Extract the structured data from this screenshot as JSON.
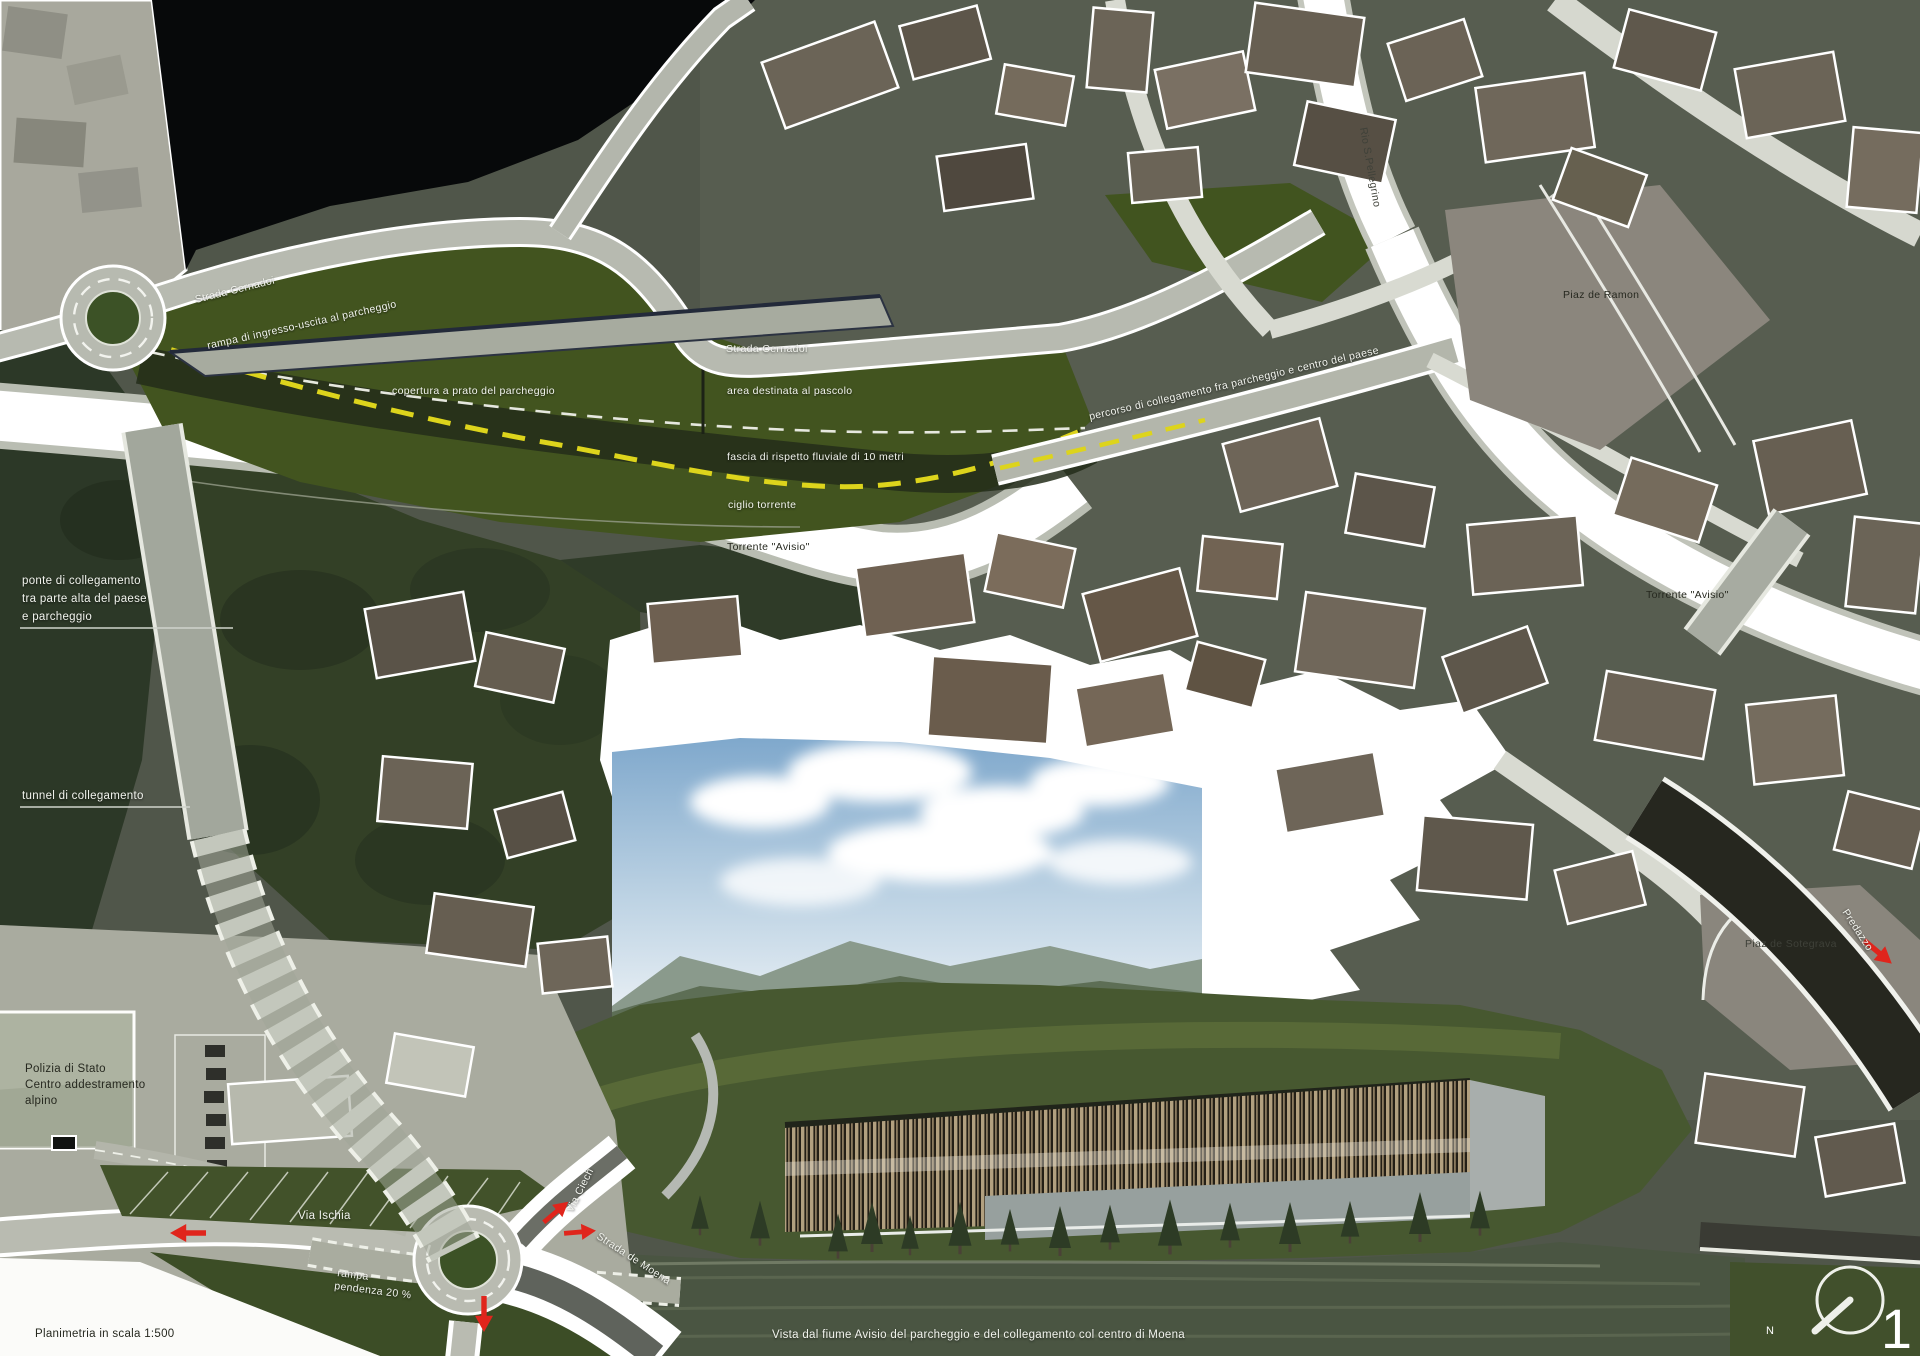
{
  "annotations": {
    "strada_cernadoi_upper": "Strada Cernadoi",
    "rampa_ingresso": "rampa di ingresso-uscita al parcheggio",
    "copertura_prato": "copertura a prato del parcheggio",
    "strada_cernadoi_mid": "Strada Cernadoi",
    "area_pascolo": "area destinata al pascolo",
    "fascia_rispetto": "fascia di rispetto fluviale di 10 metri",
    "ciglio_torrente": "ciglio torrente",
    "torrente_avisio_center": "Torrente \"Avisio\"",
    "torrente_avisio_right": "Torrente \"Avisio\"",
    "percorso_collegamento": "percorso di collegamento fra parcheggio e centro del paese",
    "piaz_de_ramon": "Piaz de Ramon",
    "rio_s_pellegrino": "Rio S.Pellegrino",
    "ponte_line1": "ponte di collegamento",
    "ponte_line2": "tra parte alta del paese",
    "ponte_line3": "e parcheggio",
    "tunnel": "tunnel di collegamento",
    "polizia_line1": "Polizia di Stato",
    "polizia_line2": "Centro addestramento",
    "polizia_line3": "alpino",
    "via_ischia": "Via Ischia",
    "via_ciech": "Via Ciech",
    "strada_de_moena": "Strada de Moena",
    "rampa_line1": "rampa",
    "rampa_line2": "pendenza 20 %",
    "piaz_de_sotegrava": "Piaz de Sotegrava",
    "predazzo": "Predazzo"
  },
  "footer": {
    "scale_label": "Planimetria in scala 1:500",
    "view_caption": "Vista dal fiume Avisio del parcheggio e del collegamento col centro di Moena",
    "sheet_number": "1",
    "north_label": "N"
  },
  "icons": {
    "north_compass": "circle-with-needle",
    "direction_arrow": "red-arrow"
  },
  "colors": {
    "park_green": "#42541f",
    "forest_green": "#2f3b28",
    "route_yellow": "#ddd41c",
    "arrow_red": "#e0251c",
    "river_white": "#ffffff",
    "road_gray": "#b7bab0",
    "water_dark": "#4a5542",
    "sky_blue": "#8fb4d4",
    "timber_tan": "#b2a07f",
    "background_black": "#07090a"
  }
}
